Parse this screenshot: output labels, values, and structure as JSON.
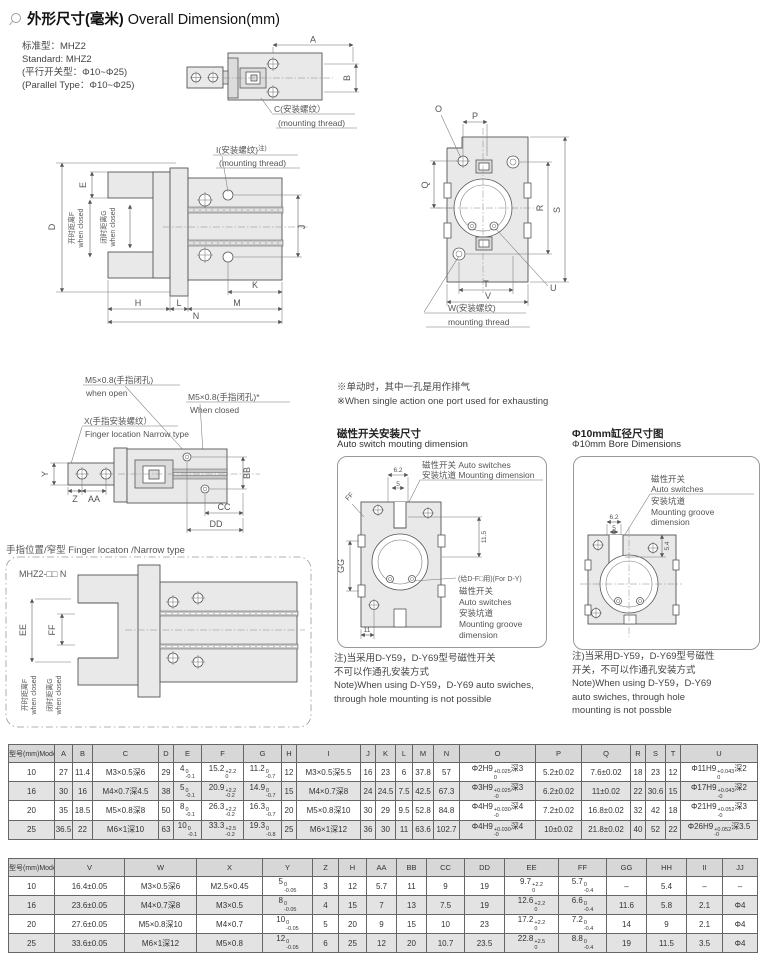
{
  "page": {
    "title_zh": "外形尺寸(毫米)",
    "title_en": " Overall Dimension(mm)"
  },
  "standard": {
    "lines": [
      "标准型：MHZ2",
      "Standard: MHZ2",
      "(平行开关型：Φ10~Φ25)",
      "(Parallel Type：Φ10~Φ25)"
    ]
  },
  "exhaust_note": {
    "lines": [
      "※单动时，其中一孔是用作排气",
      "※When single action one port used for exhausting"
    ]
  },
  "sections": {
    "switch_mount": {
      "zh": "磁性开关安装尺寸",
      "en": "Auto switch mouting dimension"
    },
    "bore": {
      "zh": "Φ10mm缸径尺寸图",
      "en": "Φ10mm Bore Dimensions"
    },
    "finger": {
      "zh": "手指位置/窄型",
      "en": " Finger locaton /Narrow type"
    }
  },
  "notes": {
    "switch_mount": [
      "注)当采用D-Y59，D-Y69型号磁性开关",
      "不可以作通孔安装方式",
      "Note)When using D-Y59，D-Y69 auto swiches,",
      "through hole mounting is not possible"
    ],
    "bore": [
      "注)当采用D-Y59，D-Y69型号磁性",
      "开关，不可以作通孔安装方式",
      "Note)When using D-Y59，D-Y69",
      "auto swiches, through hole",
      "mounting is not possble"
    ]
  },
  "drawings": {
    "top_view": {
      "dim_a": "A",
      "dim_b": "B",
      "label_c": "C(安装螺纹）",
      "label_c_en": "(mounting thread)"
    },
    "front_view": {
      "dim_d": "D",
      "dim_e": "E",
      "open_f": "开时距离F",
      "open_f_en": "when closed",
      "closed_g": "闭时距离G",
      "closed_g_en": "when closed",
      "label_i": "I(安装螺纹)",
      "label_i_sup": "注)",
      "label_i_en": "(mounting thread)",
      "dim_j": "J",
      "dim_k": "K",
      "dim_l": "L",
      "dim_m": "M",
      "dim_h": "H",
      "dim_n": "N"
    },
    "side_view": {
      "dim_o": "O",
      "dim_p": "P",
      "dim_q": "Q",
      "dim_r": "R",
      "dim_s": "S",
      "dim_t": "T",
      "dim_u": "U",
      "dim_v": "V",
      "label_w": "W(安装螺纹)",
      "label_w_en": "mounting thread"
    },
    "narrow_top": {
      "label_m5_open": "M5×0.8(手指闭孔)",
      "label_m5_open_en": "when open",
      "label_m5_closed": "M5×0.8(手指闭孔)*",
      "label_m5_closed_en": "When closed",
      "label_x": "X(手指安装螺纹）",
      "label_x_en": "Finger location Narrow type",
      "dim_y": "Y",
      "dim_z": "Z",
      "dim_aa": "AA",
      "dim_bb": "BB",
      "dim_cc": "CC",
      "dim_dd": "DD"
    },
    "narrow_front": {
      "model": "MHZ2-□□ N",
      "dim_ee": "EE",
      "dim_ff": "FF",
      "open_f": "开时距离F",
      "open_f_en": "when closed",
      "closed_g": "闭时距离G",
      "closed_g_en": "when closed"
    },
    "switch_mount_view": {
      "dim_62": "6.2",
      "dim_5": "5",
      "dim_115": "11.5",
      "dim_gg": "GG",
      "dim_11": "11",
      "dim_ff": "FF",
      "groove1": "磁性开关 Auto switches",
      "groove2": "安装坑道 Mounting dimension",
      "for_label": "(给D-F□用)(For D-Y)",
      "g1": "磁性开关",
      "g2": "Auto switches",
      "g3": "安装坑道",
      "g4": "Mounting groove",
      "g5": "dimension"
    },
    "bore_view": {
      "g1": "磁性开关",
      "g2": "Auto switches",
      "g3": "安装坑道",
      "g4": "Mounting groove",
      "g5": "dimension",
      "dim_62": "6.2",
      "dim_5": "5",
      "dim_54": "5.4"
    }
  },
  "table1": {
    "headers": [
      "型号(mm)Model",
      "A",
      "B",
      "C",
      "D",
      "E",
      "F",
      "G",
      "H",
      "I",
      "J",
      "K",
      "L",
      "M",
      "N",
      "O",
      "P",
      "Q",
      "R",
      "S",
      "T",
      "U"
    ],
    "rows": [
      [
        "10",
        "27",
        "11.4",
        "M3×0.5深6",
        "29",
        "4^{0}_{-0.1}",
        "15.2^{+2.2}_{0}",
        "11.2^{0}_{-0.7}",
        "12",
        "M3×0.5深5.5",
        "16",
        "23",
        "6",
        "37.8",
        "57",
        "Φ2H9^{+0.025}_{0}深3",
        "5.2±0.02",
        "7.6±0.02",
        "18",
        "23",
        "12",
        "Φ11H9^{+0.043}_{0}深2"
      ],
      [
        "16",
        "30",
        "16",
        "M4×0.7深4.5",
        "38",
        "5^{0}_{-0.1}",
        "20.9^{+2.2}_{-0.2}",
        "14.9^{0}_{-0.7}",
        "15",
        "M4×0.7深8",
        "24",
        "24.5",
        "7.5",
        "42.5",
        "67.3",
        "Φ3H9^{+0.025}_{-0}深3",
        "6.2±0.02",
        "11±0.02",
        "22",
        "30.6",
        "15",
        "Φ17H9^{+0.043}_{-0}深2"
      ],
      [
        "20",
        "35",
        "18.5",
        "M5×0.8深8",
        "50",
        "8^{0}_{-0.1}",
        "26.3^{+2.2}_{-0.2}",
        "16.3^{0}_{-0.7}",
        "20",
        "M5×0.8深10",
        "30",
        "29",
        "9.5",
        "52.8",
        "84.8",
        "Φ4H9^{+0.030}_{-0}深4",
        "7.2±0.02",
        "16.8±0.02",
        "32",
        "42",
        "18",
        "Φ21H9^{+0.052}_{-0}深3"
      ],
      [
        "25",
        "36.5",
        "22",
        "M6×1深10",
        "63",
        "10^{0}_{-0.1}",
        "33.3^{+2.5}_{-0.2}",
        "19.3^{0}_{-0.8}",
        "25",
        "M6×1深12",
        "36",
        "30",
        "11",
        "63.6",
        "102.7",
        "Φ4H9^{+0.030}_{-0}深4",
        "10±0.02",
        "21.8±0.02",
        "40",
        "52",
        "22",
        "Φ26H9^{+0.052}_{-0}深3.5"
      ]
    ]
  },
  "table2": {
    "headers": [
      "型号(mm)Model",
      "V",
      "W",
      "X",
      "Y",
      "Z",
      "H",
      "AA",
      "BB",
      "CC",
      "DD",
      "EE",
      "FF",
      "GG",
      "HH",
      "II",
      "JJ"
    ],
    "rows": [
      [
        "10",
        "16.4±0.05",
        "M3×0.5深6",
        "M2.5×0.45",
        "5^{0}_{-0.05}",
        "3",
        "12",
        "5.7",
        "11",
        "9",
        "19",
        "9.7^{+2.2}_{0}",
        "5.7^{0}_{-0.4}",
        "–",
        "5.4",
        "–",
        "–"
      ],
      [
        "16",
        "23.6±0.05",
        "M4×0.7深8",
        "M3×0.5",
        "8^{0}_{-0.05}",
        "4",
        "15",
        "7",
        "13",
        "7.5",
        "19",
        "12.6^{+2.2}_{0}",
        "6.6^{0}_{-0.4}",
        "11.6",
        "5.8",
        "2.1",
        "Φ4"
      ],
      [
        "20",
        "27.6±0.05",
        "M5×0.8深10",
        "M4×0.7",
        "10^{0}_{-0.05}",
        "5",
        "20",
        "9",
        "15",
        "10",
        "23",
        "17.2^{+2.2}_{0}",
        "7.2^{0}_{-0.4}",
        "14",
        "9",
        "2.1",
        "Φ4"
      ],
      [
        "25",
        "33.6±0.05",
        "M6×1深12",
        "M5×0.8",
        "12^{0}_{-0.05}",
        "6",
        "25",
        "12",
        "20",
        "10.7",
        "23.5",
        "22.8^{+2.5}_{0}",
        "8.8^{0}_{-0.4}",
        "19",
        "11.5",
        "3.5",
        "Φ4"
      ]
    ]
  }
}
